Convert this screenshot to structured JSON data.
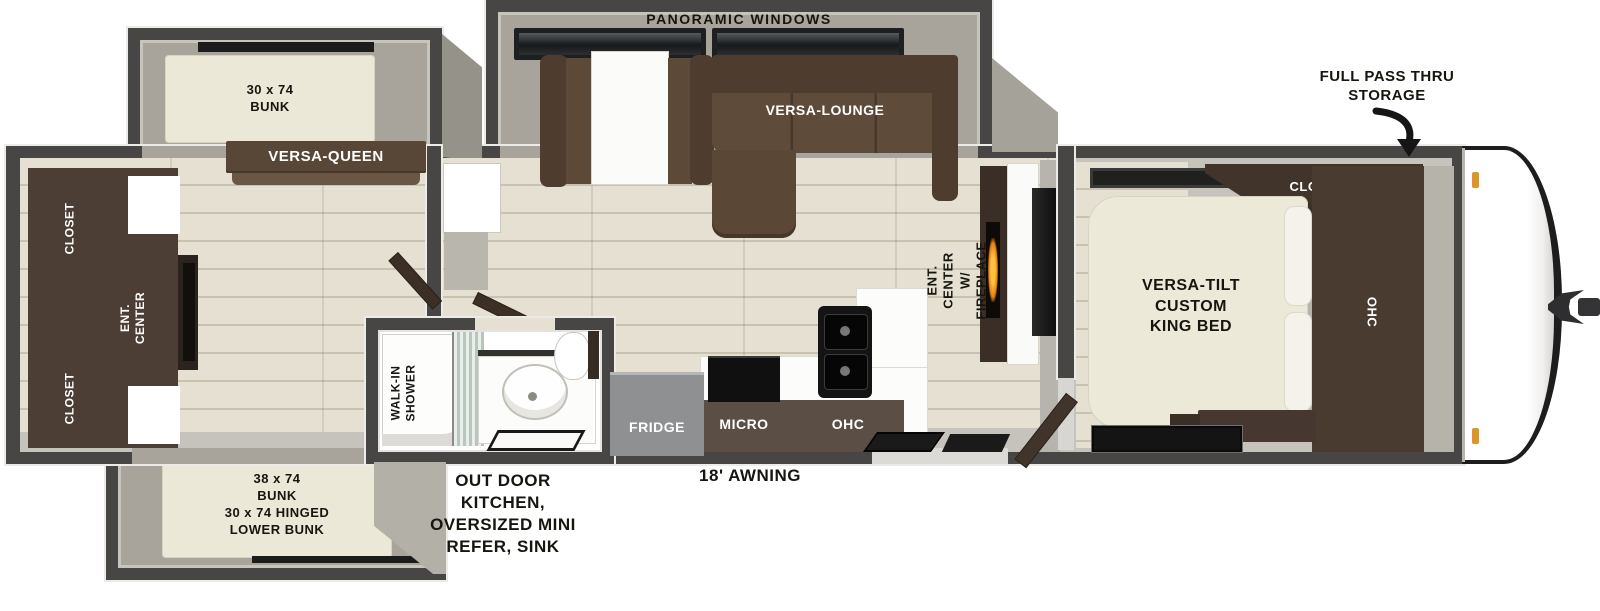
{
  "title": "Travel trailer floor plan",
  "colors": {
    "wall": "#474644",
    "slide_interior": "#a8a49b",
    "wood_floor": "#e5e0d1",
    "gray_floor": "#c6c3bc",
    "sofa_brown": "#5f4b3a",
    "cabinet_brown": "#4a3b31",
    "bed_cream": "#ede9d8",
    "fridge_gray": "#8f9092",
    "appliance_black": "#141414",
    "flame_orange": "#f59a1d",
    "annotation_text": "#17150f"
  },
  "labels": {
    "panoramic_windows": "PANORAMIC WINDOWS",
    "full_pass_thru_storage": "FULL PASS THRU\nSTORAGE",
    "versa_lounge": "VERSA-LOUNGE",
    "bunk_upper": "30 x 74\nBUNK",
    "versa_queen": "VERSA-QUEEN",
    "closet_rear_top": "CLOSET",
    "ent_center_rear": "ENT. CENTER",
    "closet_rear_bottom": "CLOSET",
    "bunk_lower": "38 x 74\nBUNK\n30 x 74 HINGED\nLOWER BUNK",
    "walk_in_shower": "WALK-IN\nSHOWER",
    "outdoor_kitchen": "OUT DOOR\nKITCHEN,\nOVERSIZED MINI\nREFER, SINK",
    "awning": "18' AWNING",
    "fridge": "FRIDGE",
    "micro": "MICRO",
    "ohc_kitchen": "OHC",
    "ent_center_fireplace": "ENT. CENTER\nW/ FIREPLACE",
    "closet_front": "CLOSEST",
    "king_bed": "VERSA-TILT\nCUSTOM\nKING BED",
    "ohc_bedroom": "OHC"
  }
}
